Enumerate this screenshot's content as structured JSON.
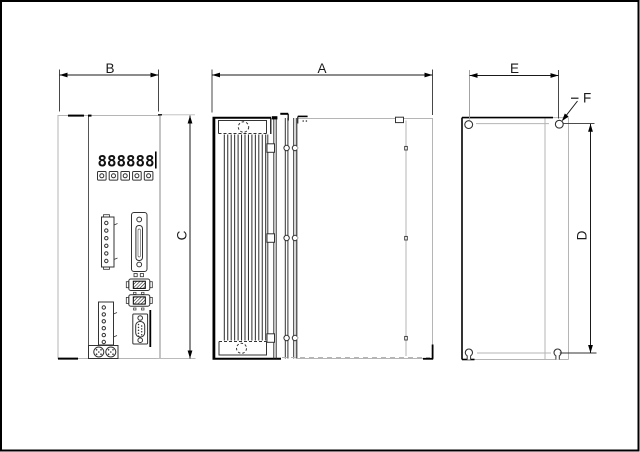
{
  "colors": {
    "ink": "#000000",
    "faint_line": "#b5b5b5",
    "background": "#ffffff"
  },
  "dimension_labels": {
    "a": "A",
    "b": "B",
    "c": "C",
    "d": "D",
    "e": "E",
    "f": "F"
  },
  "front_view": {
    "display_value": "888888"
  }
}
